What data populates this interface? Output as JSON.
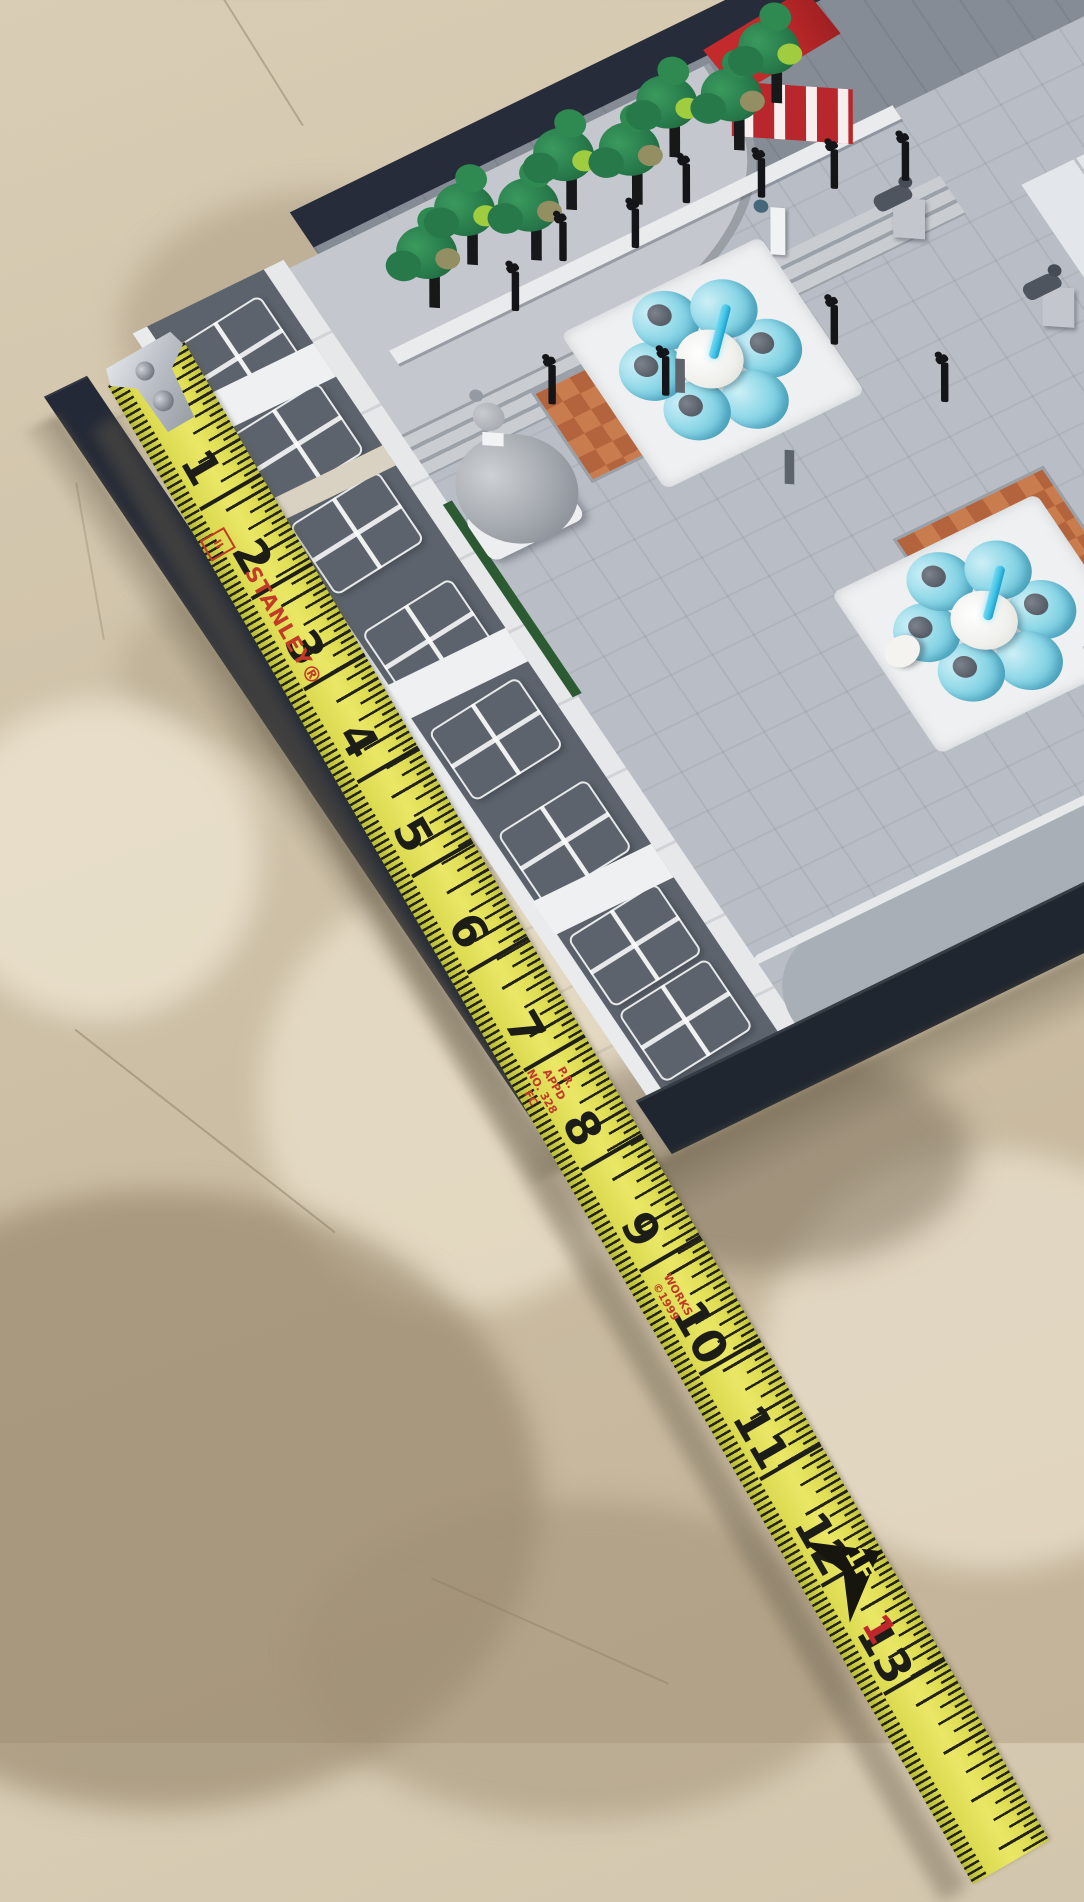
{
  "tape": {
    "brand": "STANLEY®",
    "accuracy_class_mark": "II",
    "inch_labels": [
      "1",
      "2",
      "3",
      "4",
      "5",
      "6",
      "7",
      "8",
      "9",
      "10",
      "11",
      "12",
      "13"
    ],
    "red_inch_label": "1",
    "foot_marker_label": "1F",
    "fine_print_upper": "P.R. APPD\nNO. 328 FC",
    "fine_print_lower": "WORKS ©1999",
    "colors": {
      "blade_yellow": "#e0de55",
      "markings_black": "#1f1f1a",
      "brand_red": "#c23a28",
      "hook_metal": "#b9bdc4"
    }
  },
  "model": {
    "colors": {
      "baseplate_navy": "#232936",
      "plaza_gray": "#b9bec6",
      "facade_white": "#eef0f2",
      "roof_dark_gray": "#5c636c",
      "terrace_gray": "#868c96",
      "dome_gray": "#a2a7ad",
      "terracotta": "#c97c4e",
      "terracotta_dark": "#b4643c",
      "tree_dark_green": "#27794a",
      "tree_lime_green": "#a0cc3f",
      "tree_olive": "#938f63",
      "trunk_black": "#17181a",
      "fountain_water_blue": "#8fd8e8",
      "fountain_jet_blue": "#3fc4e8",
      "red_building": "#c22a2b",
      "lamppost_black": "#141518",
      "lion_gray": "#4e555e"
    }
  },
  "floor": {
    "colors": {
      "base_tan": "#cfc2a9",
      "light_cream": "#e9dfca",
      "dark_shadow": "#96846c"
    }
  }
}
